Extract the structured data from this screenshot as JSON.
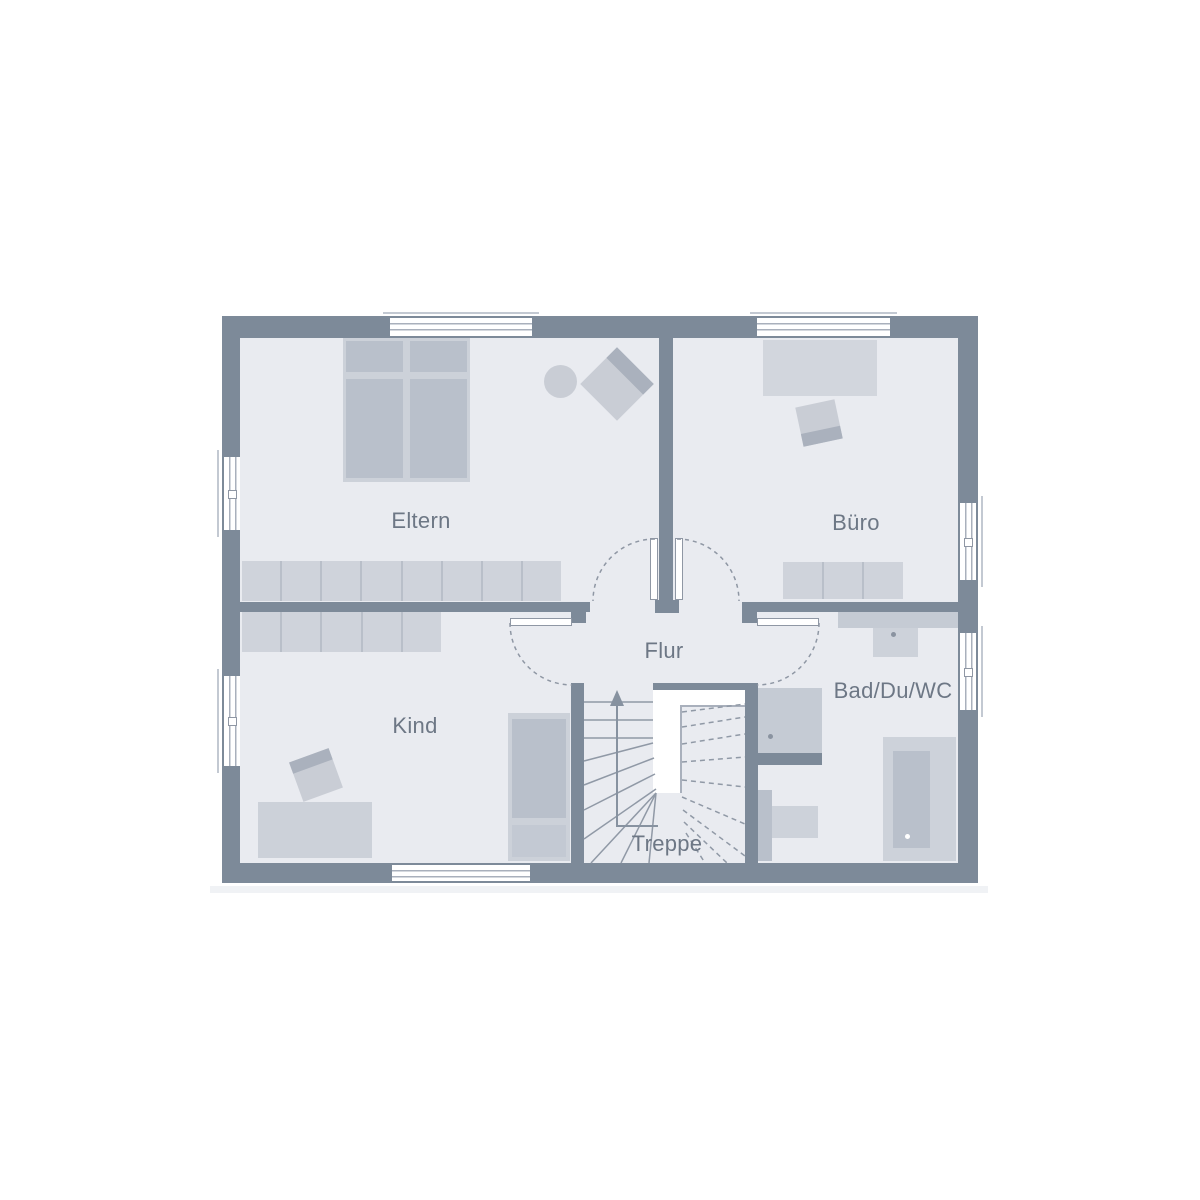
{
  "plan_type": "floor-plan-upper-storey",
  "rooms": {
    "eltern": {
      "label": "Eltern"
    },
    "buero": {
      "label": "Büro"
    },
    "kind": {
      "label": "Kind"
    },
    "flur": {
      "label": "Flur"
    },
    "bad": {
      "label": "Bad/Du/WC"
    },
    "treppe": {
      "label": "Treppe"
    }
  },
  "colors": {
    "wall": "#7d8a99",
    "floor": "#e9ebf0",
    "window": "#ffffff",
    "furniture_light": "#d2d6dd",
    "furniture_mid": "#ccd1d9",
    "furniture_dark": "#b9c0cb",
    "outline": "#8f97a4",
    "label_text": "#6d7785"
  }
}
